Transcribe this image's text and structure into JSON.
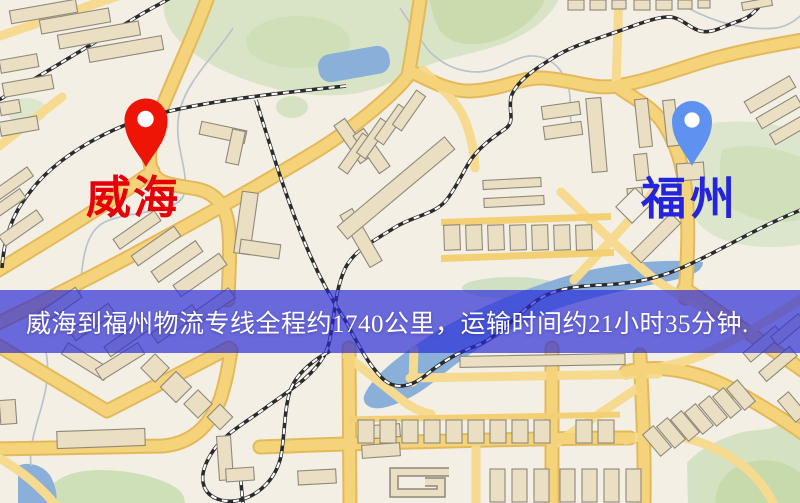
{
  "map": {
    "origin": {
      "label": "威海",
      "label_color": "#e60008",
      "pin_color": "#ee1506",
      "pin_hole_color": "#ffffff"
    },
    "destination": {
      "label": "福州",
      "label_color": "#2424dc",
      "pin_color": "#5f92f0",
      "pin_hole_color": "#ffffff"
    },
    "banner": {
      "text": "威海到福州物流专线全程约1740公里，运输时间约21小时35分钟.",
      "text_color": "#ffffff",
      "overlay_color": "rgba(40,42,215,0.68)"
    },
    "route_facts": {
      "origin_city": "威海",
      "destination_city": "福州",
      "service": "物流专线",
      "distance_text": "约1740公里",
      "duration_text": "约21小时35分钟"
    }
  }
}
